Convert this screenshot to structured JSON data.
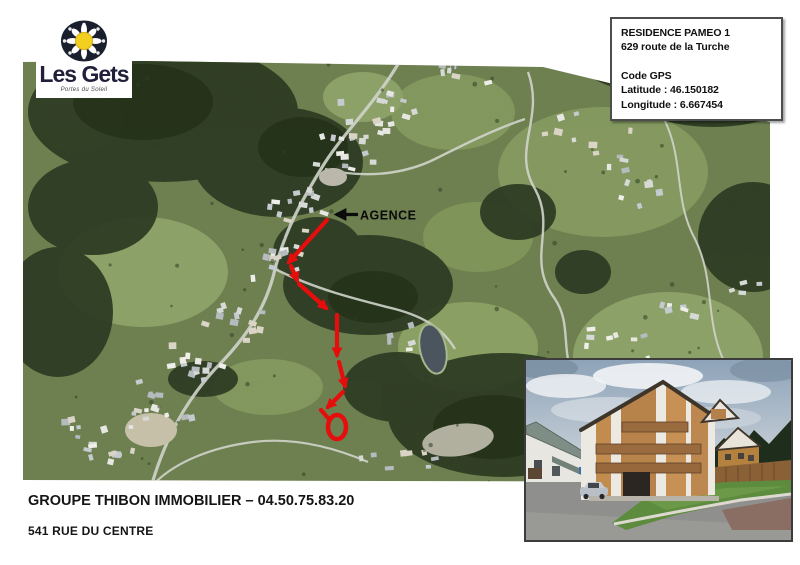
{
  "logo": {
    "title": "Les Gets",
    "subtitle": "Portes du Soleil"
  },
  "gps_box": {
    "title": "RESIDENCE PAMEO 1",
    "address": "629 route de la Turche",
    "gps_label": "Code GPS",
    "latitude": "Latitude : 46.150182",
    "longitude": "Longitude : 6.667454"
  },
  "map": {
    "agency_label": "AGENCE"
  },
  "footer": {
    "line1": "GROUPE THIBON IMMOBILIER – 04.50.75.83.20",
    "line2": "541 RUE DU CENTRE"
  },
  "colors": {
    "route": "#e60d0d",
    "agency_arrow": "#0b0b0b"
  }
}
